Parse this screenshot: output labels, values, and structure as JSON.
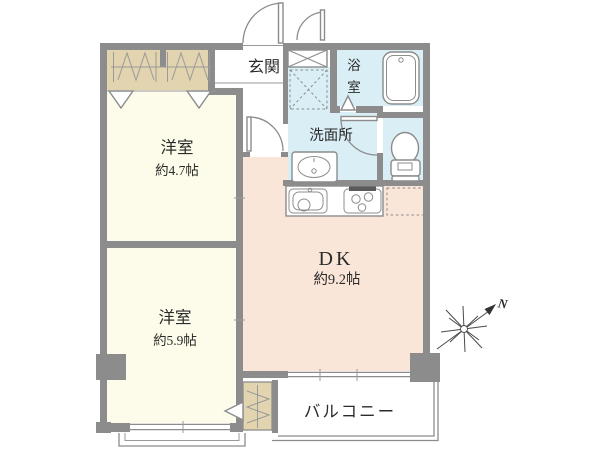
{
  "colors": {
    "wall": "#8c8c8c",
    "room_cream": "#fdfbe9",
    "closet_tan": "#e2d4af",
    "water_blue": "#d9eef5",
    "dk_peach": "#fae6d8",
    "hall_white": "#ffffff",
    "balcony_white": "#ffffff",
    "stove_grill_dark": "#5a5a5a",
    "text": "#2b2b2b"
  },
  "rooms": {
    "entrance": {
      "label": "玄関"
    },
    "bathroom": {
      "label": "浴室",
      "char1": "浴",
      "char2": "室"
    },
    "washroom": {
      "label": "洗面所"
    },
    "western_room_1": {
      "label": "洋室",
      "size": "約4.7帖"
    },
    "western_room_2": {
      "label": "洋室",
      "size": "約5.9帖"
    },
    "dining_kitchen": {
      "label": "DK",
      "size": "約9.2帖"
    },
    "balcony": {
      "label": "バルコニー"
    }
  },
  "compass": {
    "north_label": "N"
  }
}
